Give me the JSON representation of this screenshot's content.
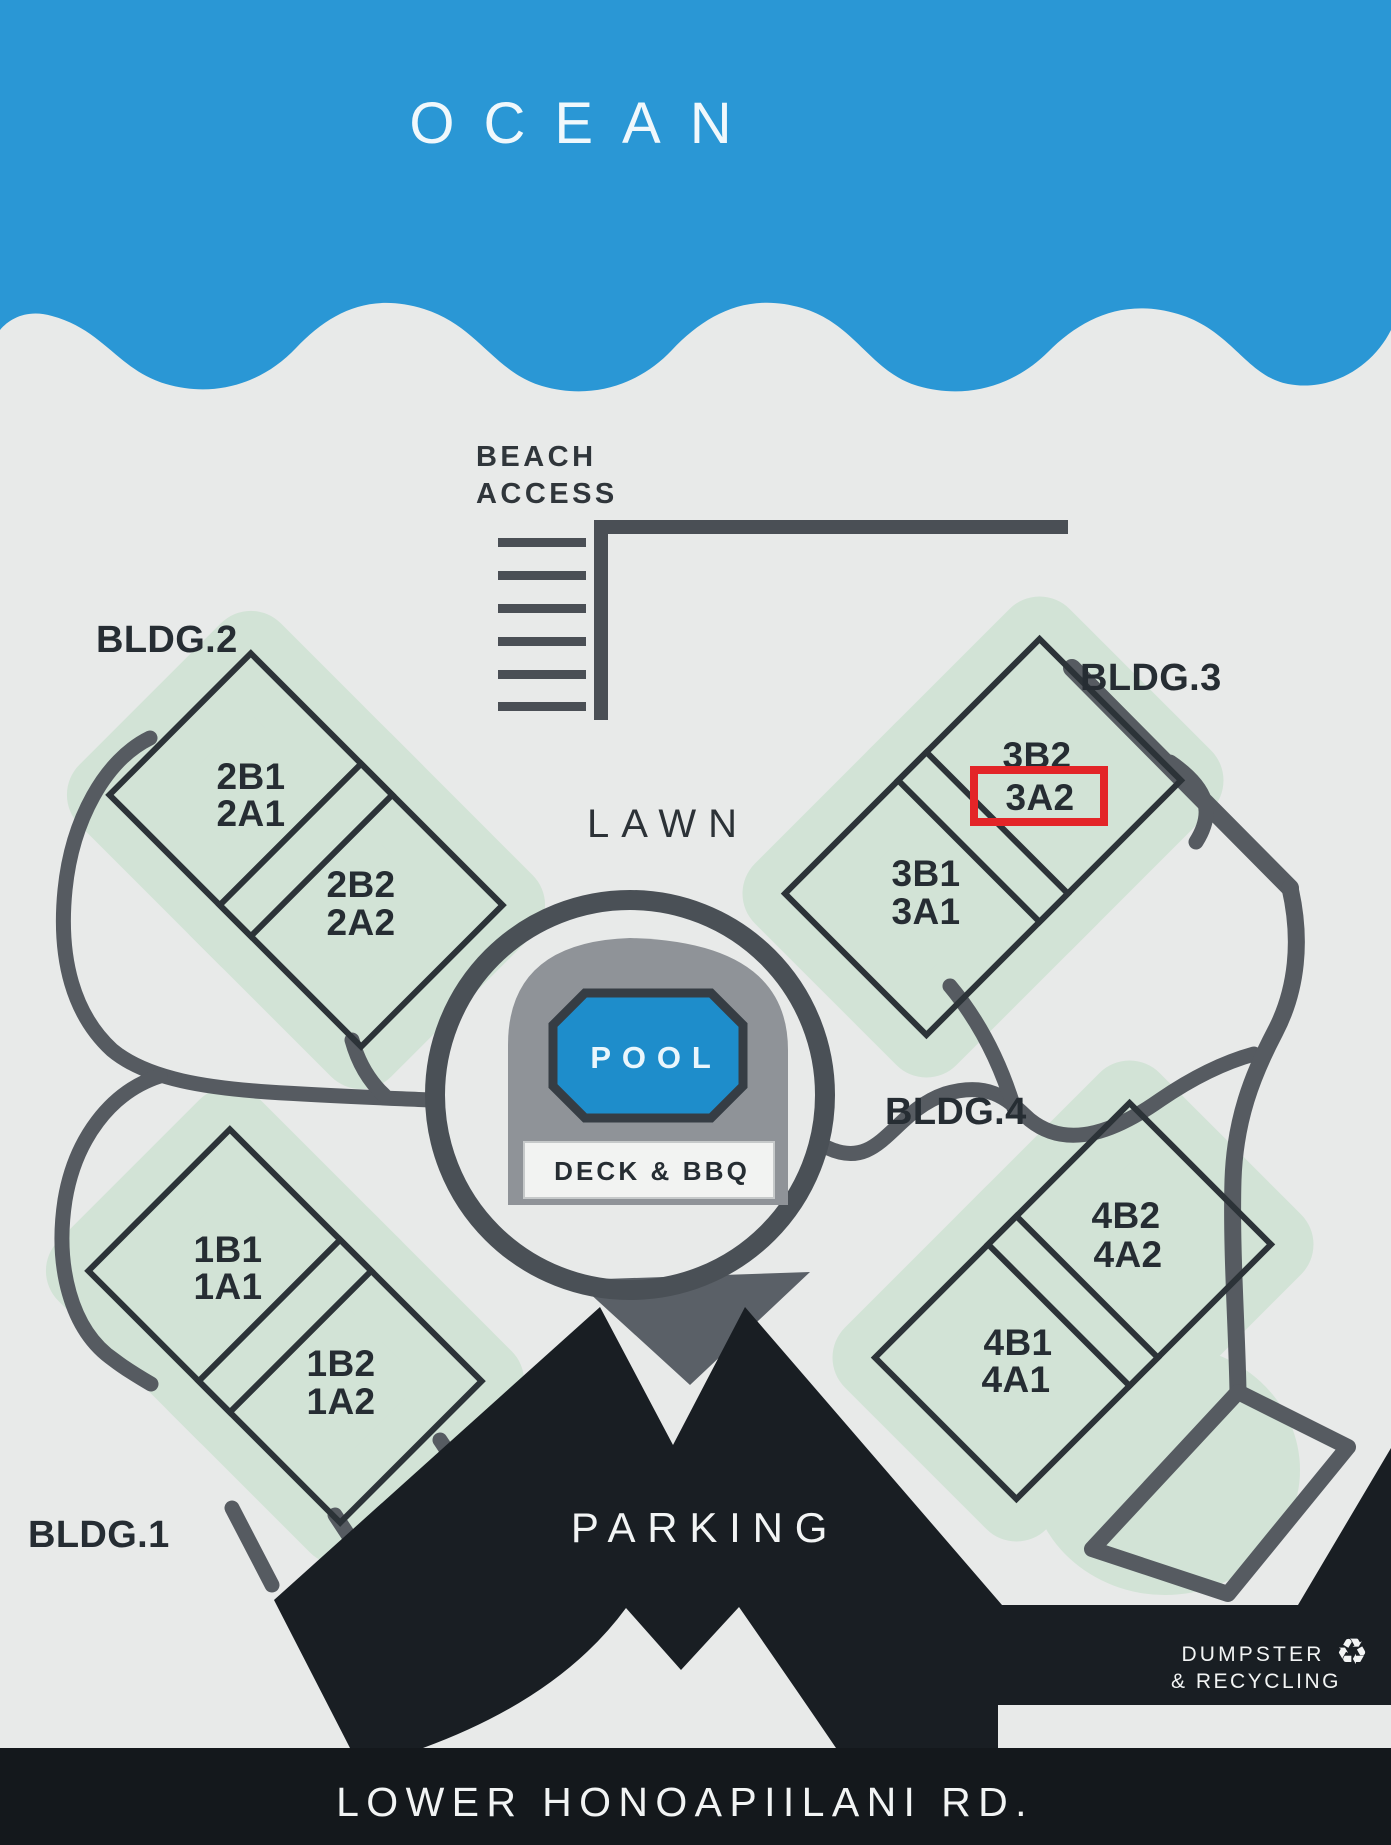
{
  "sign": {
    "ocean": "OCEAN",
    "beach_access": [
      "BEACH",
      "ACCESS"
    ],
    "lawn": "LAWN",
    "pool": "POOL",
    "deck_bbq": "DECK & BBQ",
    "parking": "PARKING",
    "dumpster": [
      "DUMPSTER",
      "& RECYCLING"
    ],
    "recycle_icon": "♻",
    "road": "LOWER HONOAPIILANI RD."
  },
  "buildings": [
    {
      "label": "BLDG.1",
      "unit_groups": [
        [
          "1B1",
          "1A1"
        ],
        [
          "1B2",
          "1A2"
        ]
      ]
    },
    {
      "label": "BLDG.2",
      "unit_groups": [
        [
          "2B1",
          "2A1"
        ],
        [
          "2B2",
          "2A2"
        ]
      ]
    },
    {
      "label": "BLDG.3",
      "unit_groups": [
        [
          "3B1",
          "3A1"
        ],
        [
          "3B2",
          "3A2"
        ]
      ]
    },
    {
      "label": "BLDG.4",
      "unit_groups": [
        [
          "4B1",
          "4A1"
        ],
        [
          "4B2",
          "4A2"
        ]
      ]
    }
  ],
  "highlight": {
    "unit": "3A2",
    "color": "#e32528"
  },
  "colors": {
    "ocean_blue": "#2a97d5",
    "pool_blue": "#1e8dcb",
    "background": "#e8eae9",
    "green_blob": "#d2e3d6",
    "outline_dark": "#2c3338",
    "path_gray": "#565b61",
    "parking_black": "#191e23",
    "deck_gray": "#8f9398",
    "pin_gray": "#5a6067"
  }
}
